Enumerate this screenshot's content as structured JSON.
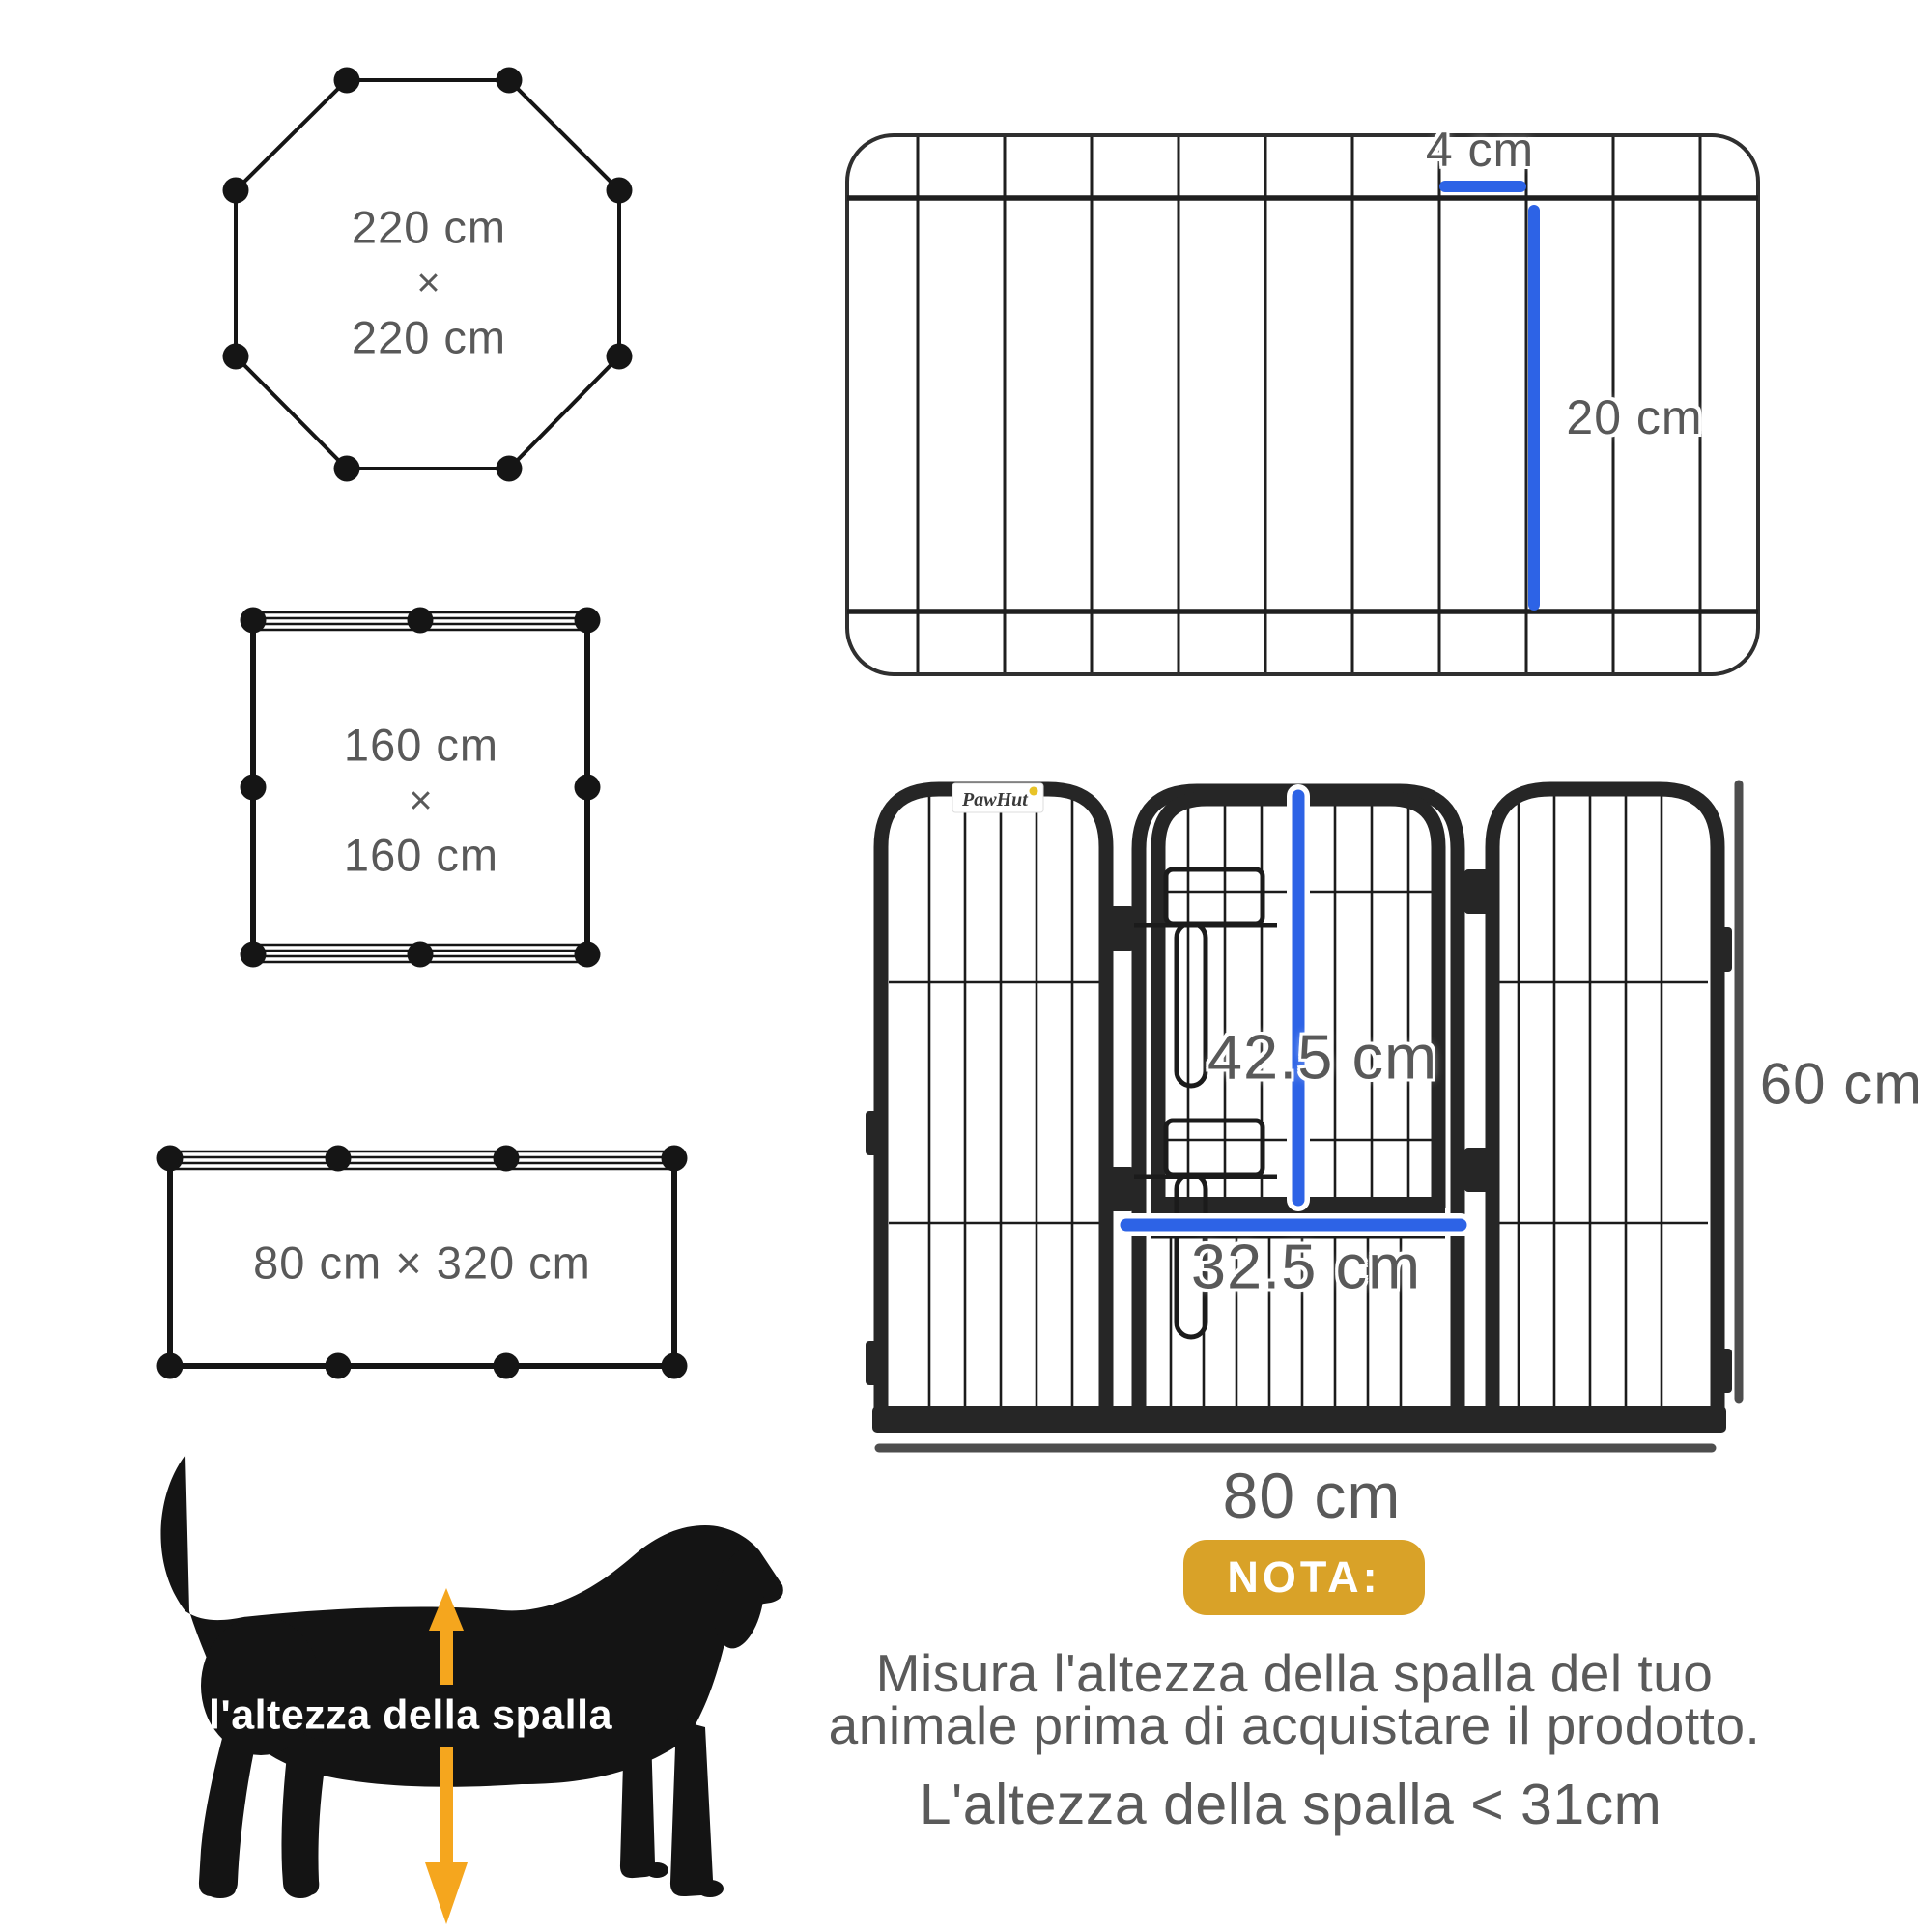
{
  "shapes": {
    "octagon": {
      "width_label": "220 cm",
      "separator": "×",
      "height_label": "220 cm"
    },
    "square": {
      "width_label": "160 cm",
      "separator": "×",
      "height_label": "160 cm"
    },
    "rectangle": {
      "size_label": "80 cm × 320 cm"
    }
  },
  "top_view": {
    "bar_gap_label": "4 cm",
    "bar_length_label": "20 cm"
  },
  "front_view": {
    "brand": "PawHut",
    "door_height_label": "42.5 cm",
    "door_width_label": "32.5 cm",
    "panel_height_label": "60 cm",
    "panel_width_label": "80 cm"
  },
  "dog": {
    "label": "l'altezza della spalla"
  },
  "note": {
    "badge": "NOTA:",
    "line1": "Misura l'altezza della spalla del tuo",
    "line2": "animale prima di acquistare il prodotto.",
    "line3": "L'altezza della spalla < 31cm"
  },
  "colors": {
    "text_gray": "#595959",
    "measure_blue": "#2d63e6",
    "note_gold": "#d9a228",
    "arrow_amber": "#f5a61e",
    "ink_black": "#151515",
    "fence_dark": "#262626",
    "measure_line_gray": "#4d4d4d"
  }
}
